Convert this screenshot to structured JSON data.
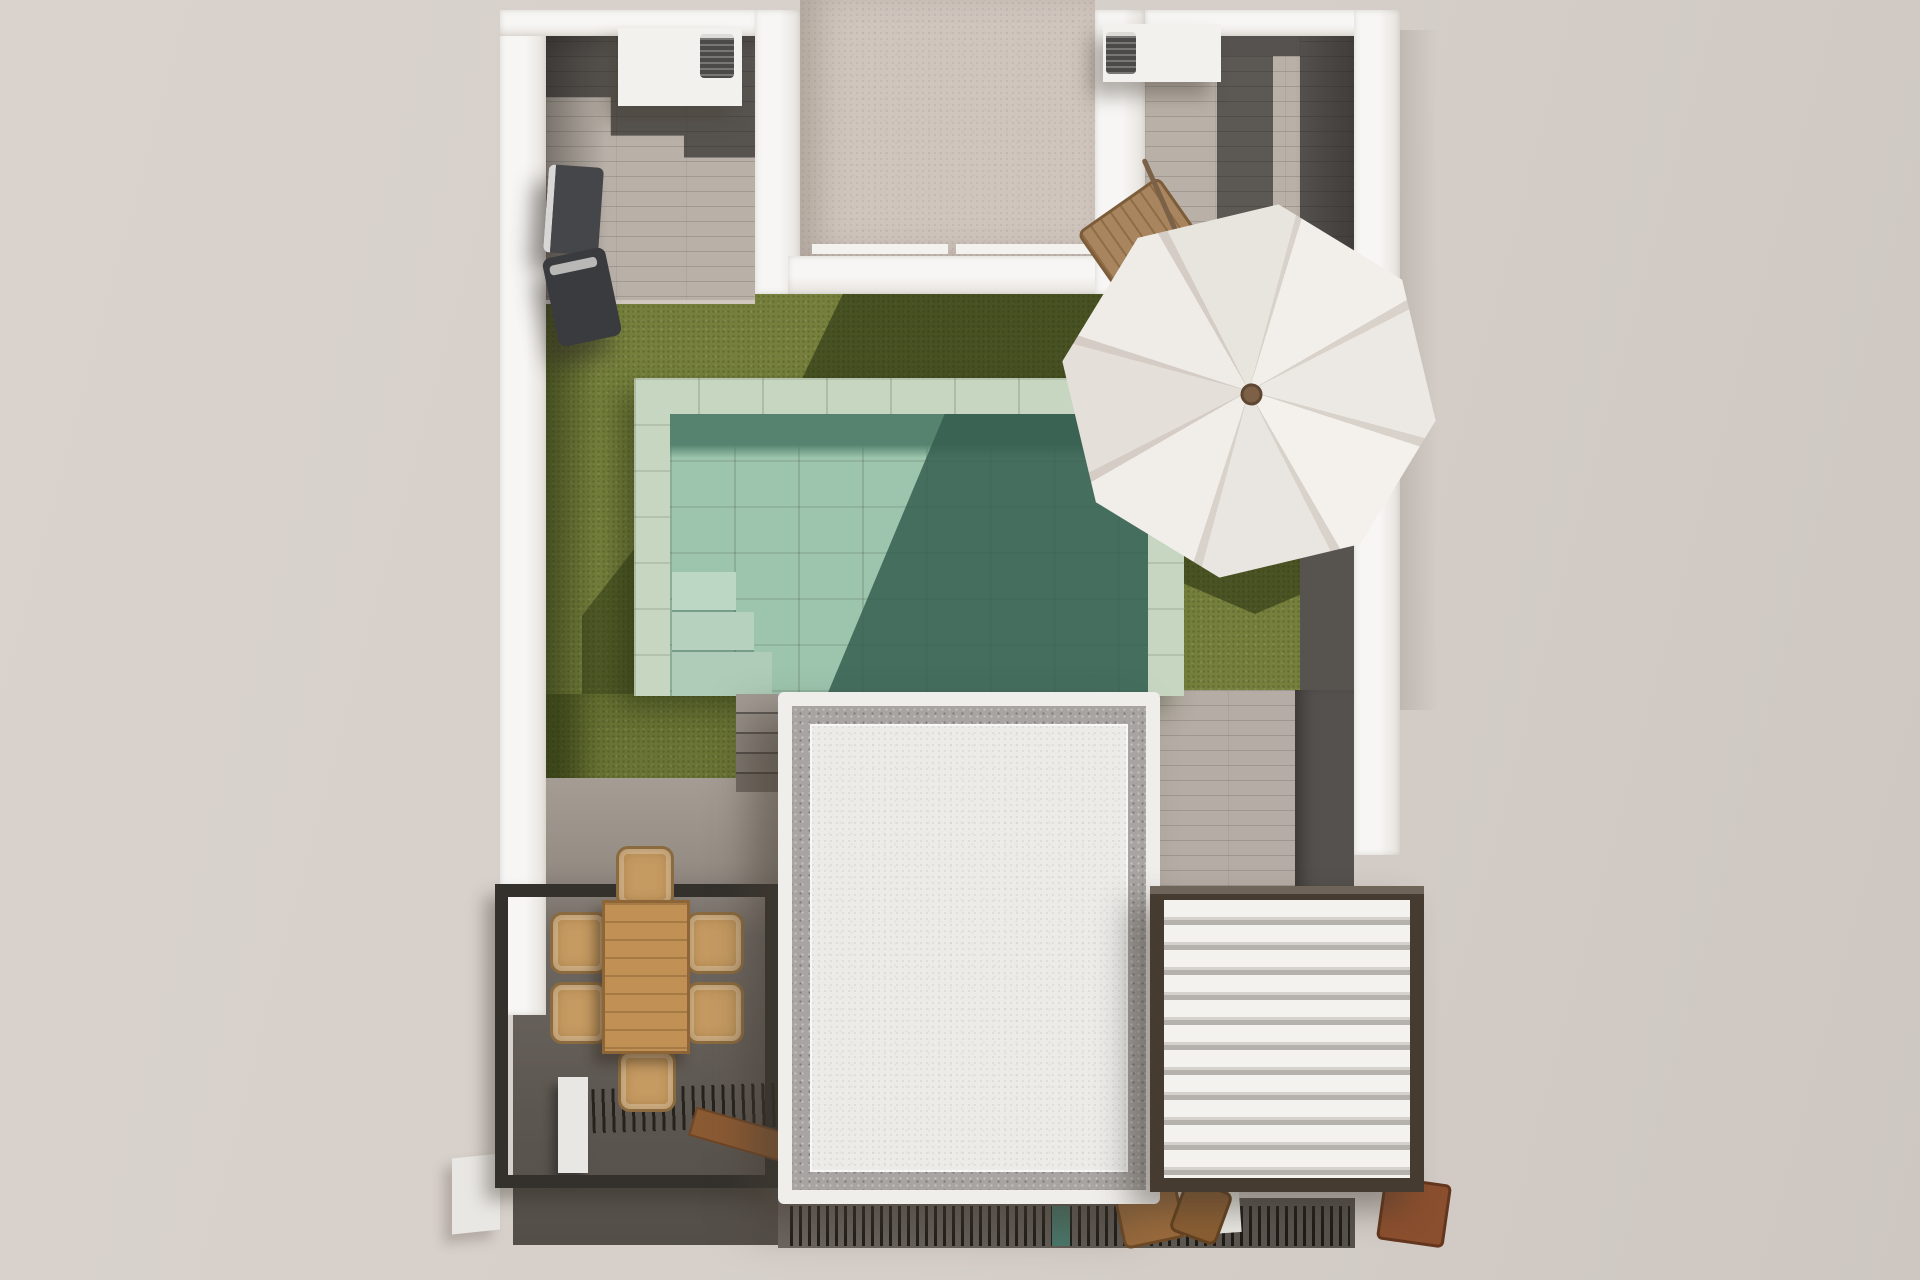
{
  "scene": {
    "title": "Aerial 3D render — villa garden terrace with pool",
    "description": "Top-down architectural rendering of a walled villa plot: two tiled side patios with air-conditioning units, a lawn with rectangular pool, tilted white parasol, timber dining terrace under a black pergola, a white gravel-edged flat roof and a white louvered pergola roof.",
    "areas": {
      "left_patio": "side patio with AC platform and outdoor sofa",
      "right_patio": "side patio with AC platform and parasol walkway",
      "entrance_roof": "flat beige roof between the two wings",
      "lawn": "artificial-grass garden",
      "pool": "rectangular pool with stone coping and interior steps",
      "dining_terrace": "timber deck with dining set under slatted pergola",
      "main_roof": "white stucco flat roof with gravel border",
      "louvered_pergola": "white bioclimatic louvered roof with dark frame"
    },
    "furniture": [
      "air-conditioning unit (left)",
      "air-conditioning unit (right)",
      "outdoor sofa",
      "tilted white parasol",
      "sun lounger",
      "wooden dining table",
      "six wicker chairs",
      "wooden bench",
      "slatted shade grill",
      "stone garden steps",
      "pool steps",
      "folded wooden deck chairs"
    ],
    "palette": {
      "background": "#d6cfc9",
      "wall_white": "#f6f5f3",
      "entrance_roof": "#cfc5bd",
      "tile_dark": "#57534f",
      "tile_light": "#b9b1a8",
      "walkway_wood": "#b5ada5",
      "lawn": "#76803c",
      "lawn_shadow": "#3c471a",
      "pool_coping": "#c7d6c0",
      "pool_water": "#9dc5ae",
      "pool_water_dark": "#4c7767",
      "pool_step": "#bdd7c5",
      "deck_light": "#a59d94",
      "deck_dark": "#5d5751",
      "stone_step": "#968f87",
      "pergola_frame": "#34312d",
      "louver_frame": "#453b31",
      "louver_white": "#f4f2ef",
      "roof_field": "#ecebe8",
      "roof_border": "#a8a4a1",
      "table_wood": "#c09055",
      "wicker": "#c69b62",
      "bench_wood": "#8a5a33",
      "umbrella_canopy": "#efebe6",
      "umbrella_pole": "#7b6147",
      "ac_unit": "#4b4a48",
      "teal_item": "#49796c",
      "planter_white": "#e9e7e3"
    }
  }
}
